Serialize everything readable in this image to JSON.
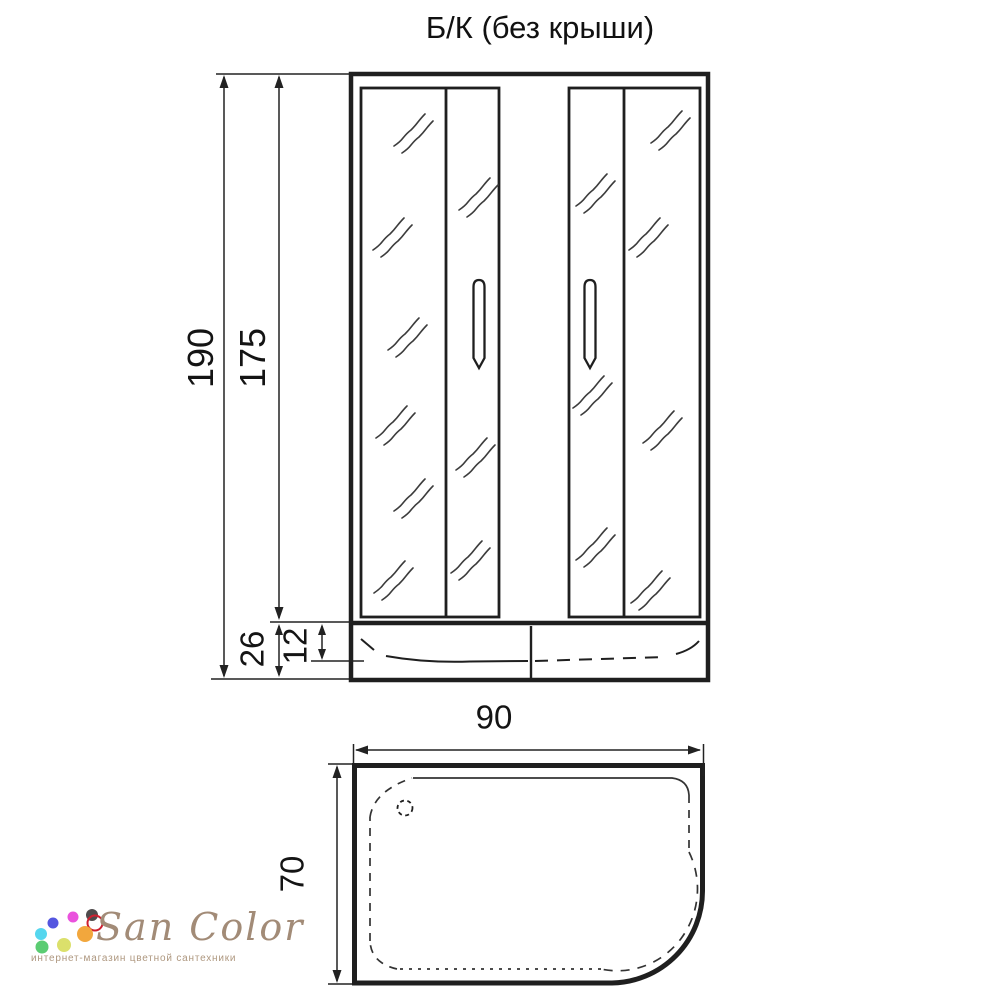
{
  "title": "Б/К (без крыши)",
  "front_view": {
    "description": "front elevation of shower cabin with two sliding glass door sections and low tray",
    "dims": {
      "total_height": "190",
      "door_height": "175",
      "tray_height": "26",
      "rim_height": "12"
    }
  },
  "top_view": {
    "description": "plan view of asymmetric shower tray with rounded front-right corner and drain",
    "dims": {
      "width": "90",
      "depth": "70"
    }
  },
  "logo": {
    "brand": "San Color",
    "tagline": "интернет-магазин цветной сантехники",
    "text_color": "#a28b77",
    "dots": [
      {
        "x": 53,
        "y": 923,
        "size": 11,
        "color": "#5456e0"
      },
      {
        "x": 73,
        "y": 917,
        "size": 11,
        "color": "#ea52dd"
      },
      {
        "x": 92,
        "y": 915,
        "size": 12,
        "color": "#4f4b4c"
      },
      {
        "x": 95,
        "y": 923,
        "size": 13,
        "color": "#cf2030",
        "ring": true
      },
      {
        "x": 41,
        "y": 934,
        "size": 12,
        "color": "#55d6ee"
      },
      {
        "x": 85,
        "y": 934,
        "size": 16,
        "color": "#f2a73d"
      },
      {
        "x": 42,
        "y": 947,
        "size": 13,
        "color": "#5bcc72"
      },
      {
        "x": 64,
        "y": 945,
        "size": 14,
        "color": "#dbe06b"
      }
    ]
  },
  "colors": {
    "line": "#1f1f1f",
    "background": "#ffffff"
  }
}
